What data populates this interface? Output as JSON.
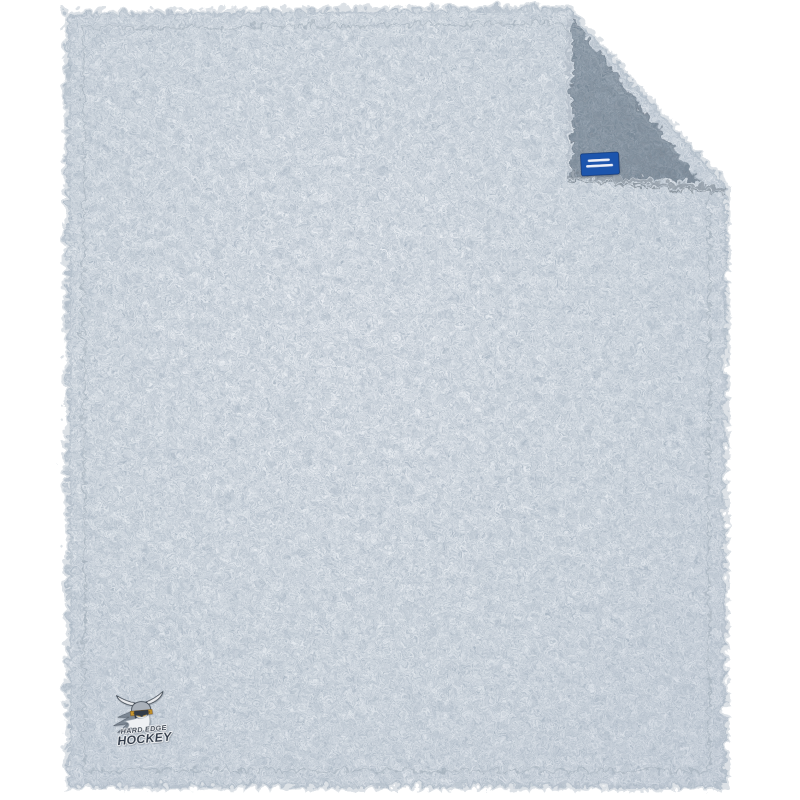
{
  "scene": {
    "kind": "product-photo",
    "subject": "Sherpa fleece blanket with folded top-right corner",
    "background_color": "#ffffff"
  },
  "blanket": {
    "front_color": "#e4e9ee",
    "front_speckle_color": "#8e99a6",
    "flap_back_color": "#87919d",
    "flap_speckle_color": "#4e5a66",
    "hem_color": "#b2bcc7"
  },
  "tag": {
    "color": "#1e55ad",
    "outline_color": "#123a78",
    "text_line_color": "#ffffff"
  },
  "logo": {
    "line1": "HARD EDGE",
    "line2": "HOCKEY",
    "text_color": "#2e3947",
    "outline_color": "#f5f7f9",
    "helmet_color": "#aab1ba",
    "band_color": "#c8962f",
    "stud_color": "#7a5a12",
    "horn_color": "#e9ebee",
    "beard_color": "#eef0f3",
    "mustache_color": "#f6f8fa",
    "face_color": "#313b47",
    "accent_gold": "#d8a93f",
    "hair_color": "#7d8894"
  }
}
